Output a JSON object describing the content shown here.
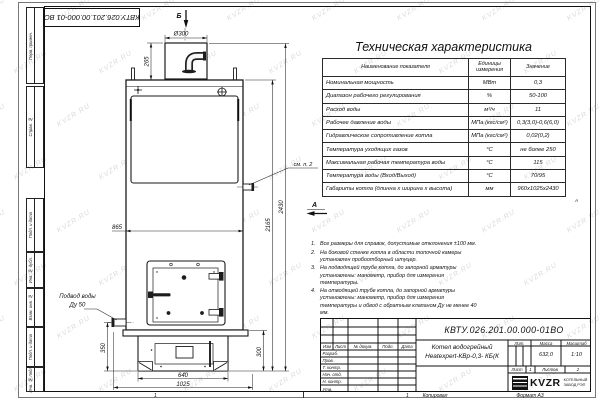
{
  "watermark": {
    "text": "KVZR.RU"
  },
  "frame": {
    "corner_doc_number": "КВТУ.026.201.00.000-01 ВО",
    "zone_label": "А",
    "margin_boxes": [
      {
        "label": "Перв. примен."
      },
      {
        "label": "Справ. №"
      },
      {
        "label": "Подп. и дата"
      },
      {
        "label": "Инв. № дубл."
      },
      {
        "label": "Взам. инв. №"
      },
      {
        "label": "Подп. и дата"
      },
      {
        "label": "Инв. № подл."
      }
    ]
  },
  "drawing": {
    "view_labels": {
      "top": "Б",
      "front": "А"
    },
    "dims": {
      "flue_diameter": "Ø300",
      "flue_height": "265",
      "body_width": "865",
      "total_height": "2430",
      "shell_height": "2165",
      "inlet_height": "350",
      "base_height": "300",
      "base_width": "640",
      "overall_width": "1025"
    },
    "callouts": {
      "see_note": "см. п. 2",
      "water_supply": "Подвод воды",
      "water_supply_dn": "Ду 50"
    }
  },
  "spec_table": {
    "title": "Техническая характеристика",
    "headers": [
      "Наименование показателя",
      "Единицы измерения",
      "Значение"
    ],
    "rows": [
      [
        "Номинальная мощность",
        "МВт",
        "0,3"
      ],
      [
        "Диапазон рабочего регулирования",
        "%",
        "50-100"
      ],
      [
        "Расход воды",
        "м³/ч",
        "11"
      ],
      [
        "Рабочее давление воды",
        "МПа (кгс/см²)",
        "0,3(3,0)-0,6(6,0)"
      ],
      [
        "Гидравлическое сопротивление котла",
        "МПа (кгс/см²)",
        "0,02(0,2)"
      ],
      [
        "Температура уходящих газов",
        "°С",
        "не более 250"
      ],
      [
        "Максимальная рабочая температура воды",
        "°С",
        "115"
      ],
      [
        "Температура воды (Вход/Выход)",
        "°С",
        "70/95"
      ],
      [
        "Габариты котла (длинна х ширина х высота)",
        "мм",
        "960х1025х2430"
      ]
    ]
  },
  "notes": [
    "Все размеры для справок, допустимые отклонения ±100 мм.",
    "На боковой стенке котла в области топочной камеры установлен пробоотборный штуцер.",
    "На подводящей трубе котла, до запорной арматуры установлены: манометр, прибор для измерения температуры.",
    "На отводящей трубе котла, до запорной арматуры установлены: манометр, прибор для измерения температуры и обвод с обратным клапаном Ду не менее 40 мм."
  ],
  "title_block": {
    "doc_number": "КВТУ.026.201.00.000-01ВО",
    "product_name": [
      "Котел водогрейный",
      "Heatexpert-КВр-0,3- КБ(К"
    ],
    "rev_header": [
      "Изм",
      "Лист",
      "№ докум.",
      "Подп.",
      "Дата"
    ],
    "role_rows": [
      "Разраб.",
      "Пров.",
      "Т. контр.",
      "Нач. отд.",
      "Н. контр.",
      "Утв."
    ],
    "lit_label": "Лит.",
    "mass_label": "Масса",
    "scale_label": "Масштаб",
    "mass_value": "632,0",
    "scale_value": "1:10",
    "sheet_label": "Лист",
    "sheet_value": "1",
    "sheets_label": "Листов",
    "sheets_value": "2",
    "logo_text": "KVZR",
    "org_line1": "КОТЕЛЬНЫЙ",
    "org_line2": "ЗАВОД РЭП"
  },
  "footer": {
    "zone_left": "1",
    "zone_right": "1",
    "copied": "Копировал",
    "format": "Формат А3"
  }
}
